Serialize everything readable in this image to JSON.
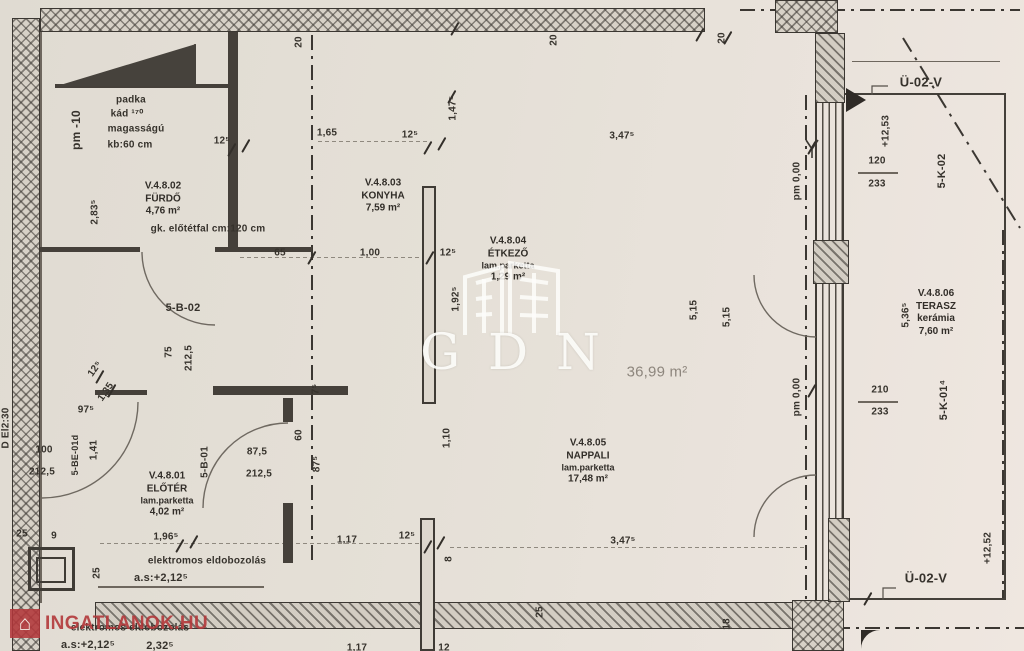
{
  "watermarks": {
    "gdn": "GDN",
    "portal": "INGATLANOK.HU",
    "portal_icon": "⌂"
  },
  "rooms": {
    "eloter": {
      "code": "V.4.8.01",
      "name": "ELŐTÉR",
      "floor": "lam.parketta",
      "area": "4,02 m²"
    },
    "furdo": {
      "code": "V.4.8.02",
      "name": "FÜRDŐ",
      "area": "4,76 m²"
    },
    "konyha": {
      "code": "V.4.8.03",
      "name": "KONYHA",
      "area": "7,59 m²"
    },
    "etkezo": {
      "code": "V.4.8.04",
      "name": "ÉTKEZŐ",
      "floor": "lam.parketta",
      "area": "1,29 m²"
    },
    "nappali": {
      "code": "V.4.8.05",
      "name": "NAPPALI",
      "floor": "lam.parketta",
      "area": "17,48 m²"
    },
    "terasz": {
      "code": "V.4.8.06",
      "name": "TERASZ",
      "floor": "kerámia",
      "area": "7,60 m²"
    }
  },
  "areas": {
    "open_space": "36,99 m²"
  },
  "notes": {
    "padka_1": "padka",
    "padka_2": "kád ¹⁷⁰",
    "padka_3": "magasságú",
    "padka_4": "kb:60 cm",
    "gk_elotetfal": "gk. előtétfal cm:120 cm",
    "elektromos_1": "elektromos eldobozolás",
    "elektromos_2": "a.s:+2,12⁵",
    "pm_minus10": "pm -10",
    "pm_000": "pm 0,00"
  },
  "codes": {
    "sb02": "5-B-02",
    "sb01": "5-B-01",
    "sbe01d": "5-BE-01d",
    "sk02": "5-K-02",
    "sk01": "5-K-01⁴",
    "del230": "D El2:30",
    "u02v": "Ü-02-V"
  },
  "levels": {
    "p1253": "+12,53",
    "p1252": "+12,52"
  },
  "dims": {
    "t20a": "20",
    "t20b": "20",
    "t20c": "20",
    "d125a": "12⁵",
    "d283": "2,83⁵",
    "d65": "65",
    "d165": "1,65",
    "d125b": "12⁵",
    "d147": "1,47⁵",
    "d347t": "3,47⁵",
    "d100": "1,00",
    "d125c": "12⁵",
    "d192": "1,92⁵",
    "d515a": "5,15",
    "d515b": "5,15",
    "d75": "75",
    "d2125a": "212,5",
    "d125d": "12⁵",
    "d135": "1,35",
    "d975": "97⁵",
    "d100b": "100",
    "d2125b": "212,5",
    "d141": "1,41",
    "d875a": "87,5",
    "d2125c": "212,5",
    "d60": "60",
    "d875b": "87⁵",
    "d75b": "7⁵",
    "d25a": "25",
    "d9": "9",
    "d25b": "25",
    "d196": "1,96⁵",
    "d117a": "1,17",
    "d125e": "12⁵",
    "d110": "1,10",
    "d8": "8",
    "d347b": "3,47⁵",
    "d25c": "25",
    "d18": "18",
    "d232": "2,32⁵",
    "d117b": "1,17",
    "d12b": "12",
    "d120": "120",
    "d233a": "233",
    "d536": "5,36⁵",
    "d210": "210",
    "d233b": "233"
  }
}
